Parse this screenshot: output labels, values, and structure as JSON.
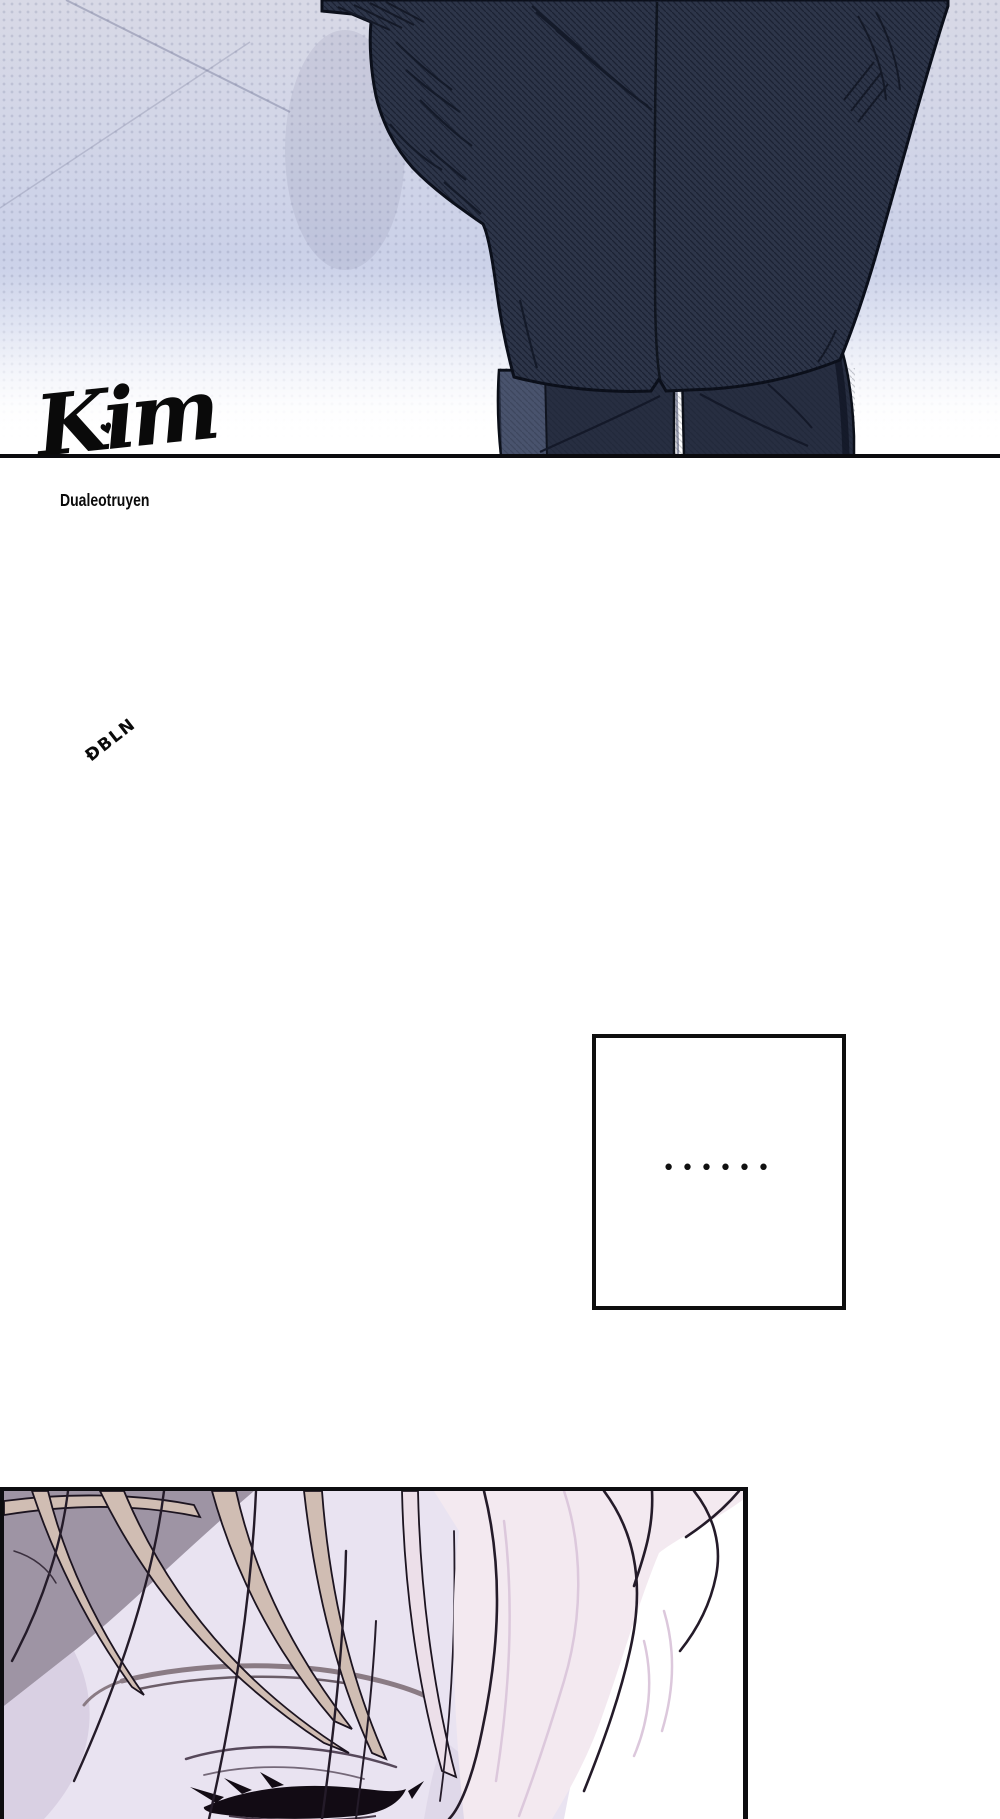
{
  "watermark": {
    "tag": "ĐBLN",
    "logo": "Kim",
    "heart": "♥",
    "credit": "Dualeotruyen"
  },
  "speech_box": {
    "dots": "••••••"
  },
  "colors": {
    "top_panel_gradient_top": "#d8d9e6",
    "top_panel_gradient_mid": "#cbd1e8",
    "top_panel_fade": "#ffffff",
    "suit_jacket": "#2d3549",
    "suit_outline": "#0b0f1a",
    "trousers": "#272e41",
    "trousers_highlight": "#49536d",
    "panel_border": "#0d0d10",
    "divider_line": "#0b0b0e",
    "hair_light_pink": "#f3e9f0",
    "hair_beige": "#d0bdb3",
    "hair_shadow_grey": "#9e94a4",
    "skin": "#e9e3f1",
    "eyelash_ink": "#120b14",
    "watermark_ink": "#0a0a0a"
  }
}
